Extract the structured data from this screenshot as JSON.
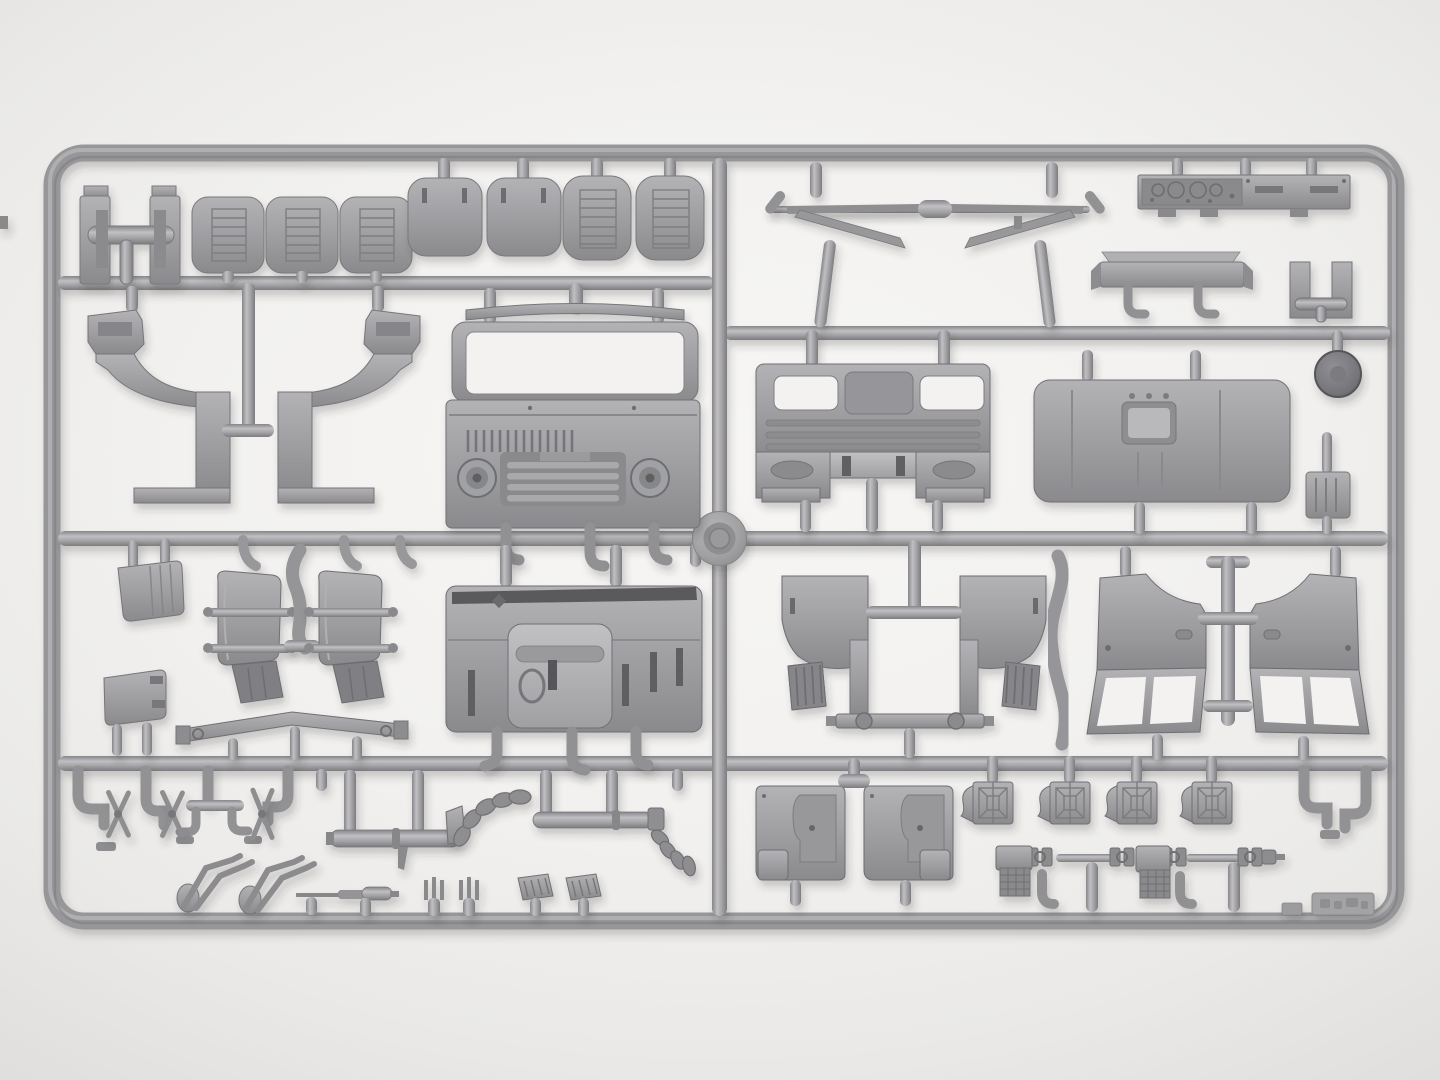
{
  "scene": {
    "description": "Overhead photo of a light-gray injection-molded model-kit sprue containing truck cab parts on a white background",
    "plastic_color": "#9a9a9d",
    "plastic_highlight": "#c2c2c5",
    "plastic_shadow": "#77777a",
    "background_color": "#f2f1ef",
    "frame_shape": "rounded rectangle with internal runner grid and center mold boss"
  },
  "parts": {
    "sprue_frame": {
      "label": "Sprue outer frame"
    },
    "runners": {
      "label": "Internal runner bars"
    },
    "mold_boss": {
      "label": "Round mold boss at runner crossing"
    },
    "seat_mount_bracket": {
      "label": "Seat mount T-bracket"
    },
    "seat_cushion_row": {
      "label": "Three ribbed seat cushions"
    },
    "seat_base_pair": {
      "label": "Two smooth seat bases with slots"
    },
    "seat_backrest_pair": {
      "label": "Two ribbed seat backrests"
    },
    "mirror_arm_left": {
      "label": "Left mirror-arm bracket assembly"
    },
    "mirror_arm_right": {
      "label": "Right mirror-arm bracket assembly"
    },
    "instrument_panel": {
      "label": "Instrument panel with gauges"
    },
    "front_bumper": {
      "label": "Front bumper"
    },
    "engine_mount_bracket": {
      "label": "Paired mount brackets with tie bar"
    },
    "wheel_hub_cap": {
      "label": "Dark round hub cap"
    },
    "cab_side_frame_left": {
      "label": "Left cab side frame with sill"
    },
    "cab_side_frame_right": {
      "label": "Right cab side frame with sill"
    },
    "cab_front_panel": {
      "label": "Cab front panel with windshield frame, grille and headlights"
    },
    "cab_rear_panel": {
      "label": "Cab rear panel with window openings"
    },
    "cab_roof_panel": {
      "label": "Cab roof panel with hatch recess"
    },
    "step_bracket": {
      "label": "Small ribbed step bracket"
    },
    "mirror_head_upper": {
      "label": "Mirror head, ribbed"
    },
    "mirror_head_lower": {
      "label": "Mirror head, plain"
    },
    "mudguard_left": {
      "label": "Curved mudguard with clamp bars"
    },
    "mudguard_right": {
      "label": "Curved mudguard with clamp bars"
    },
    "exhaust_downpipe": {
      "label": "S-shaped exhaust downpipe"
    },
    "crossmember_beam": {
      "label": "Long chassis crossmember beam"
    },
    "cab_floor_panel": {
      "label": "Cab floor panel with engine cover"
    },
    "wheel_arch_left": {
      "label": "Inner wheel arch with ribbed flap"
    },
    "wheel_arch_right": {
      "label": "Inner wheel arch with ribbed flap"
    },
    "mounting_crossbar": {
      "label": "Mounting crossbar with bosses"
    },
    "curved_pipe": {
      "label": "Curved intake pipe"
    },
    "door_frame_left": {
      "label": "Door inner frame with window"
    },
    "door_frame_right": {
      "label": "Door inner frame with window"
    },
    "pipe_elbows_left": {
      "label": "Small pipe elbows"
    },
    "spring_shackles": {
      "label": "Scissor-type shackle links"
    },
    "wiper_arm_pair_1": {
      "label": "Windshield wiper arms"
    },
    "wiper_arm_pair_2": {
      "label": "Windshield wiper arms"
    },
    "exhaust_pipe_front": {
      "label": "Exhaust pipe with collars"
    },
    "exhaust_flex_front": {
      "label": "Corrugated flex hose"
    },
    "exhaust_pipe_rear": {
      "label": "Exhaust pipe with fitting"
    },
    "exhaust_flex_rear": {
      "label": "Corrugated flex hose"
    },
    "steering_column": {
      "label": "Steering column shaft"
    },
    "fork_bracket_pair": {
      "label": "Small fork brackets"
    },
    "pedal_pair": {
      "label": "Ribbed pedal plates"
    },
    "door_card_left": {
      "label": "Door trim card"
    },
    "door_card_right": {
      "label": "Door trim card"
    },
    "cab_mount_brackets": {
      "label": "Four cab mount brackets"
    },
    "drive_shaft_assembly": {
      "label": "Drive shafts with universal joints and transfer blocks"
    },
    "pipe_elbows_right": {
      "label": "Small pipe elbows"
    },
    "embossed_tag": {
      "label": "Embossed mold tag"
    }
  }
}
